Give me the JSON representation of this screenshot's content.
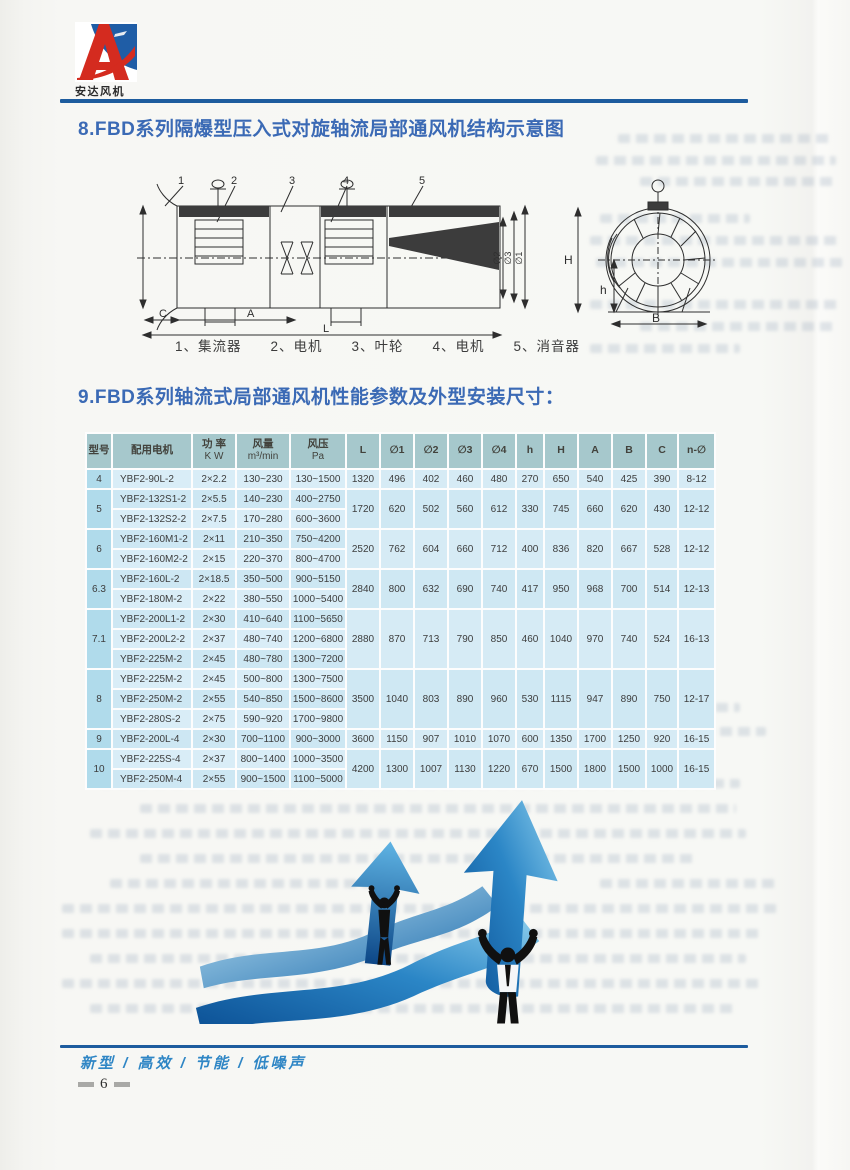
{
  "brand": {
    "name": "安达风机"
  },
  "sections": {
    "s8_title": "8.FBD系列隔爆型压入式对旋轴流局部通风机结构示意图",
    "s9_title": "9.FBD系列轴流式局部通风机性能参数及外型安装尺寸："
  },
  "diagram": {
    "caption": "1、集流器　　2、电机　　3、叶轮　　4、电机　　5、消音器",
    "side": {
      "c1": "1",
      "c2": "2",
      "c3": "3",
      "c4": "4",
      "c5": "5",
      "phi1_left": "∅1",
      "phi2": "∅2",
      "phi3": "∅3",
      "phi1_right": "∅1",
      "dim_c": "C",
      "dim_a": "A",
      "dim_l": "L"
    },
    "front": {
      "dim_H": "H",
      "dim_h": "h",
      "dim_b": "B"
    }
  },
  "table": {
    "headers": [
      {
        "t": "型号"
      },
      {
        "t": "配用电机"
      },
      {
        "t": "功 率",
        "s": "K W"
      },
      {
        "t": "风量",
        "s": "m³/min"
      },
      {
        "t": "风压",
        "s": "Pa"
      },
      {
        "t": "L"
      },
      {
        "t": "∅1"
      },
      {
        "t": "∅2"
      },
      {
        "t": "∅3"
      },
      {
        "t": "∅4"
      },
      {
        "t": "h"
      },
      {
        "t": "H"
      },
      {
        "t": "A"
      },
      {
        "t": "B"
      },
      {
        "t": "C"
      },
      {
        "t": "n-∅"
      }
    ],
    "groups": [
      {
        "model": "4",
        "rows": [
          [
            "YBF2-90L-2",
            "2×2.2",
            "130~230",
            "130~1500"
          ]
        ],
        "dims": [
          "1320",
          "496",
          "402",
          "460",
          "480",
          "270",
          "650",
          "540",
          "425",
          "390",
          "8-12"
        ]
      },
      {
        "model": "5",
        "rows": [
          [
            "YBF2-132S1-2",
            "2×5.5",
            "140~230",
            "400~2750"
          ],
          [
            "YBF2-132S2-2",
            "2×7.5",
            "170~280",
            "600~3600"
          ]
        ],
        "dims": [
          "1720",
          "620",
          "502",
          "560",
          "612",
          "330",
          "745",
          "660",
          "620",
          "430",
          "12-12"
        ]
      },
      {
        "model": "6",
        "rows": [
          [
            "YBF2-160M1-2",
            "2×11",
            "210~350",
            "750~4200"
          ],
          [
            "YBF2-160M2-2",
            "2×15",
            "220~370",
            "800~4700"
          ]
        ],
        "dims": [
          "2520",
          "762",
          "604",
          "660",
          "712",
          "400",
          "836",
          "820",
          "667",
          "528",
          "12-12"
        ]
      },
      {
        "model": "6.3",
        "rows": [
          [
            "YBF2-160L-2",
            "2×18.5",
            "350~500",
            "900~5150"
          ],
          [
            "YBF2-180M-2",
            "2×22",
            "380~550",
            "1000~5400"
          ]
        ],
        "dims": [
          "2840",
          "800",
          "632",
          "690",
          "740",
          "417",
          "950",
          "968",
          "700",
          "514",
          "12-13"
        ]
      },
      {
        "model": "7.1",
        "rows": [
          [
            "YBF2-200L1-2",
            "2×30",
            "410~640",
            "1100~5650"
          ],
          [
            "YBF2-200L2-2",
            "2×37",
            "480~740",
            "1200~6800"
          ],
          [
            "YBF2-225M-2",
            "2×45",
            "480~780",
            "1300~7200"
          ]
        ],
        "dims": [
          "2880",
          "870",
          "713",
          "790",
          "850",
          "460",
          "1040",
          "970",
          "740",
          "524",
          "16-13"
        ]
      },
      {
        "model": "8",
        "rows": [
          [
            "YBF2-225M-2",
            "2×45",
            "500~800",
            "1300~7500"
          ],
          [
            "YBF2-250M-2",
            "2×55",
            "540~850",
            "1500~8600"
          ],
          [
            "YBF2-280S-2",
            "2×75",
            "590~920",
            "1700~9800"
          ]
        ],
        "dims": [
          "3500",
          "1040",
          "803",
          "890",
          "960",
          "530",
          "1115",
          "947",
          "890",
          "750",
          "12-17"
        ]
      },
      {
        "model": "9",
        "rows": [
          [
            "YBF2-200L-4",
            "2×30",
            "700~1100",
            "900~3000"
          ]
        ],
        "dims": [
          "3600",
          "1150",
          "907",
          "1010",
          "1070",
          "600",
          "1350",
          "1700",
          "1250",
          "920",
          "16-15"
        ]
      },
      {
        "model": "10",
        "rows": [
          [
            "YBF2-225S-4",
            "2×37",
            "800~1400",
            "1000~3500"
          ],
          [
            "YBF2-250M-4",
            "2×55",
            "900~1500",
            "1100~5000"
          ]
        ],
        "dims": [
          "4200",
          "1300",
          "1007",
          "1130",
          "1220",
          "670",
          "1500",
          "1800",
          "1500",
          "1000",
          "16-15"
        ]
      }
    ]
  },
  "footer": {
    "slogan": "新型 / 高效 / 节能 / 低噪声",
    "page": "6"
  }
}
